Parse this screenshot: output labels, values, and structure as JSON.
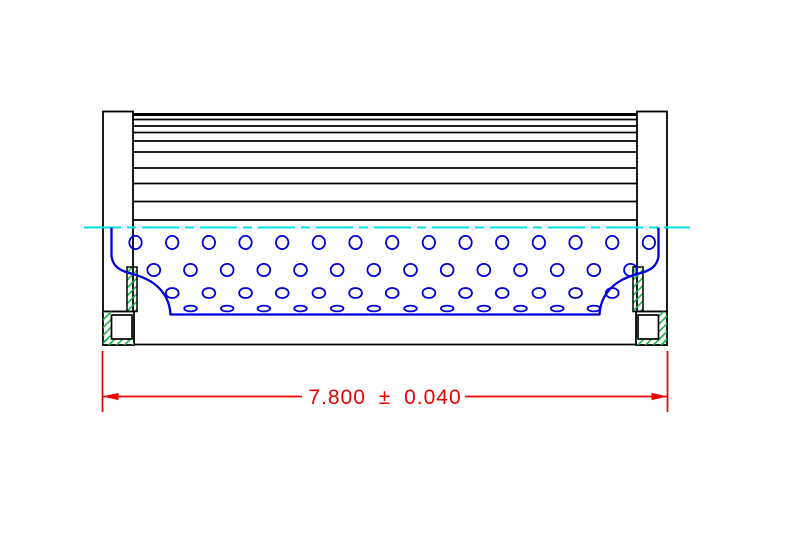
{
  "drawing": {
    "canvas": {
      "width": 789,
      "height": 546
    },
    "colors": {
      "background": "#ffffff",
      "outline": "#000000",
      "core_blue": "#0000dd",
      "centerline_cyan": "#00e2e2",
      "hatch_green": "#0fb03c",
      "dimension_red": "#ee0000"
    },
    "dimension": {
      "label": "7.800 ± 0.040",
      "nominal": "7.800",
      "plus_minus": "±",
      "tolerance": "0.040",
      "line_y": 396.5,
      "gap_x1": 302,
      "gap_x2": 465,
      "ext_x_left": 102.5,
      "ext_x_right": 667.5,
      "ext_y_top": 351,
      "ext_y_bottom": 412,
      "text_x": 385,
      "text_y": 404,
      "arrow_len": 16,
      "arrow_half": 3.6
    },
    "centerline": {
      "y": 227.5,
      "x1": 84,
      "x2": 690,
      "dash": "37 6 9 6",
      "width": 2
    },
    "pleats": {
      "x1": 133,
      "x2": 637,
      "top_y": 114.5,
      "top_width": 3,
      "line_ys": [
        119.5,
        126,
        132.5,
        141,
        152,
        168,
        183.5,
        201.5,
        220
      ],
      "line_width": 1.7
    },
    "caps": {
      "left": {
        "body": [
          103,
          111.5,
          30,
          200
        ],
        "flange_hatch": [
          127,
          267,
          10,
          44.5
        ],
        "foot_outer": [
          103,
          311.5,
          31,
          33.5
        ],
        "foot_hatch": [
          [
            103,
            311.5,
            8.5,
            33.5
          ],
          [
            103,
            338.5,
            31,
            6.5
          ]
        ],
        "foot_inner": [
          111.5,
          315,
          20.5,
          24
        ]
      },
      "right": {
        "body": [
          637,
          111.5,
          30,
          200
        ],
        "flange_hatch": [
          633,
          267,
          10,
          44.5
        ],
        "foot_outer": [
          636,
          311.5,
          31,
          33.5
        ],
        "foot_hatch": [
          [
            658.5,
            311.5,
            8.5,
            33.5
          ],
          [
            636,
            338.5,
            31,
            6.5
          ]
        ],
        "foot_inner": [
          638,
          315,
          20.5,
          24
        ]
      }
    },
    "core": {
      "outline_path": "M 111.5 227.5 L 111.5 256.5 C 113 266 119 270.5 131 273.5 C 147 278 155.5 283 162.5 292 C 167.5 298.5 170 306 170.5 314.5 L 599.5 314.5 C 600 306 602.5 298.5 607.5 292 C 614.5 283 623 278 639 273.5 C 651 270.5 657 266 658.5 256.5 L 658.5 227.5",
      "outline_width": 2.3,
      "hole_stroke_width": 1.8,
      "hole_rows": [
        {
          "cy": 242.5,
          "rx": 6.2,
          "ry": 6.6,
          "x0": 135.5,
          "dx": 36.67,
          "n": 15
        },
        {
          "cy": 270.0,
          "rx": 6.4,
          "ry": 6.1,
          "x0": 153.8,
          "dx": 36.67,
          "n": 14
        },
        {
          "cy": 293.0,
          "rx": 6.4,
          "ry": 5.0,
          "x0": 172.2,
          "dx": 36.67,
          "n": 13
        },
        {
          "cy": 308.5,
          "rx": 6.3,
          "ry": 2.9,
          "x0": 190.5,
          "dx": 36.67,
          "n": 12
        }
      ]
    },
    "bottom_edge": {
      "y": 344.5,
      "x1": 134,
      "x2": 636,
      "width": 1.8
    }
  }
}
